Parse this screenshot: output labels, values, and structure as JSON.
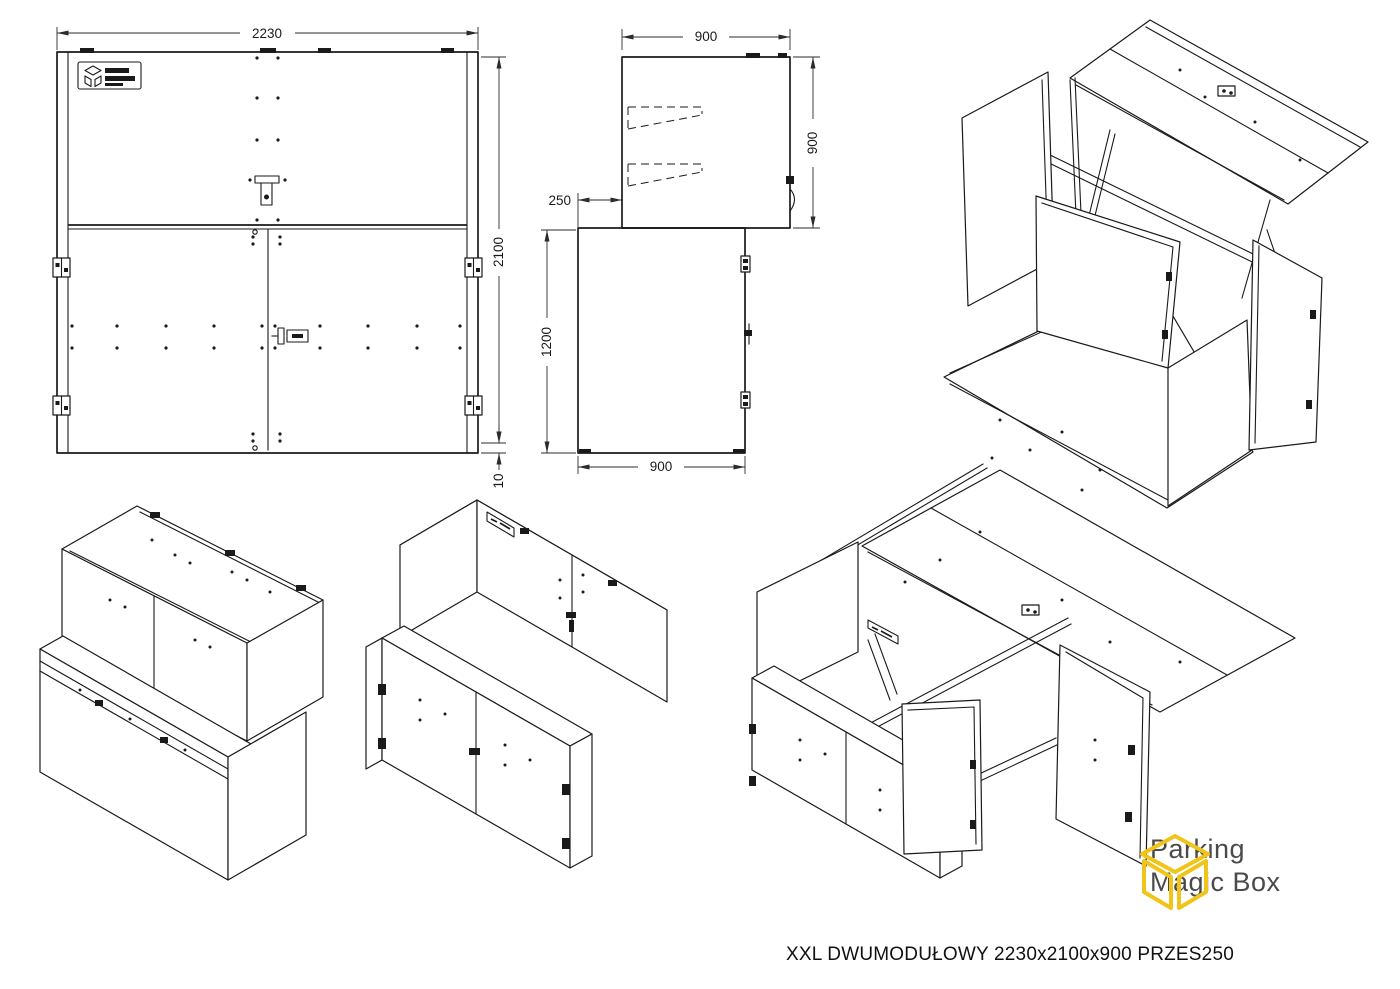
{
  "title": "XXL DWUMODUŁOWY 2230x2100x900 PRZES250",
  "logo": {
    "line1": "Parking",
    "line2": "Magic Box"
  },
  "dimensions": {
    "front_width": "2230",
    "front_height": "2100",
    "front_base": "10",
    "plan_width": "900",
    "plan_depth": "900",
    "plan_offset": "250",
    "side_height": "1200",
    "side_depth": "900"
  },
  "colors": {
    "line": "#1a1a1a",
    "dimension": "#2b2b2b",
    "logo_cube": "#F0C419",
    "logo_text": "#4a4a4a",
    "background": "#ffffff"
  }
}
